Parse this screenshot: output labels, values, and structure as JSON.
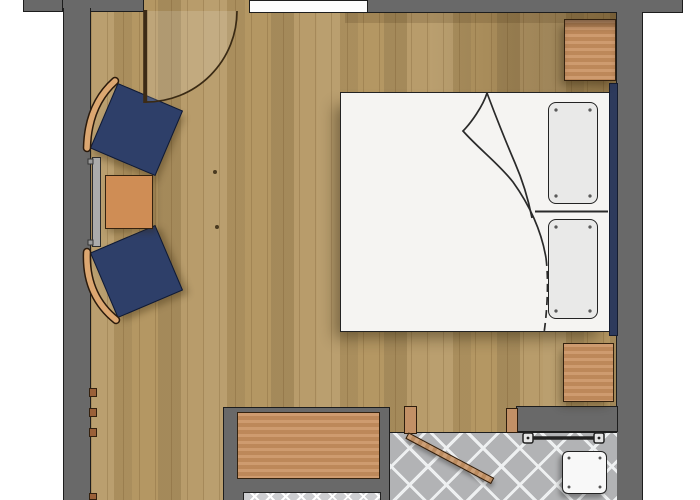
{
  "meta": {
    "title": "Hotel room floor plan",
    "view": "top-down",
    "image_px": {
      "width": 700,
      "height": 500
    }
  },
  "colors": {
    "outside": "#ffffff",
    "wall": "#696969",
    "wall_outline": "#1d1d1d",
    "floor": "#b49763",
    "bed_white": "#f5f4f2",
    "pillow": "#e9e9e8",
    "line_dark": "#2b2b2b",
    "headboard_navy": "#2d3a5c",
    "wood_furniture": "#c9905f",
    "wood_outline": "#34220f",
    "chair_navy": "#2e3f69",
    "chair_wood": "#dca771",
    "radiator": "#ababab",
    "tile": "#b2b3b5",
    "tile_line": "#eef0f1",
    "rack": "#cdced1",
    "rack_line": "#ffffff",
    "stool": "#f8f8f8"
  },
  "rooms": [
    {
      "name": "bedroom",
      "floor_material": "wood-parquet"
    },
    {
      "name": "bathroom",
      "floor_material": "diagonal-ceramic-tile"
    }
  ],
  "elements": [
    {
      "name": "entry-door",
      "state": "open-90-degrees",
      "wall": "top-left",
      "swing_arc": true
    },
    {
      "name": "window",
      "wall": "top"
    },
    {
      "name": "double-bed",
      "bedding": "white-duvet-with-folded-corner",
      "pillow_count": 2
    },
    {
      "name": "headboard",
      "color": "navy"
    },
    {
      "name": "nightstand-top-right"
    },
    {
      "name": "nightstand-bottom-right"
    },
    {
      "name": "armchair-upper",
      "upholstery": "navy",
      "backrest": "curved-wood"
    },
    {
      "name": "armchair-lower",
      "upholstery": "navy",
      "backrest": "curved-wood"
    },
    {
      "name": "side-table",
      "material": "wood"
    },
    {
      "name": "radiator",
      "wall": "left"
    },
    {
      "name": "wall-hooks",
      "count": 4
    },
    {
      "name": "desk-sideboard",
      "material": "wood"
    },
    {
      "name": "luggage-rack",
      "pattern": "crossed-straps"
    },
    {
      "name": "bathroom-door",
      "state": "ajar",
      "material": "wood"
    },
    {
      "name": "door-jamb",
      "count": 2
    },
    {
      "name": "towel-rail"
    },
    {
      "name": "shower-stool",
      "color": "white"
    }
  ]
}
